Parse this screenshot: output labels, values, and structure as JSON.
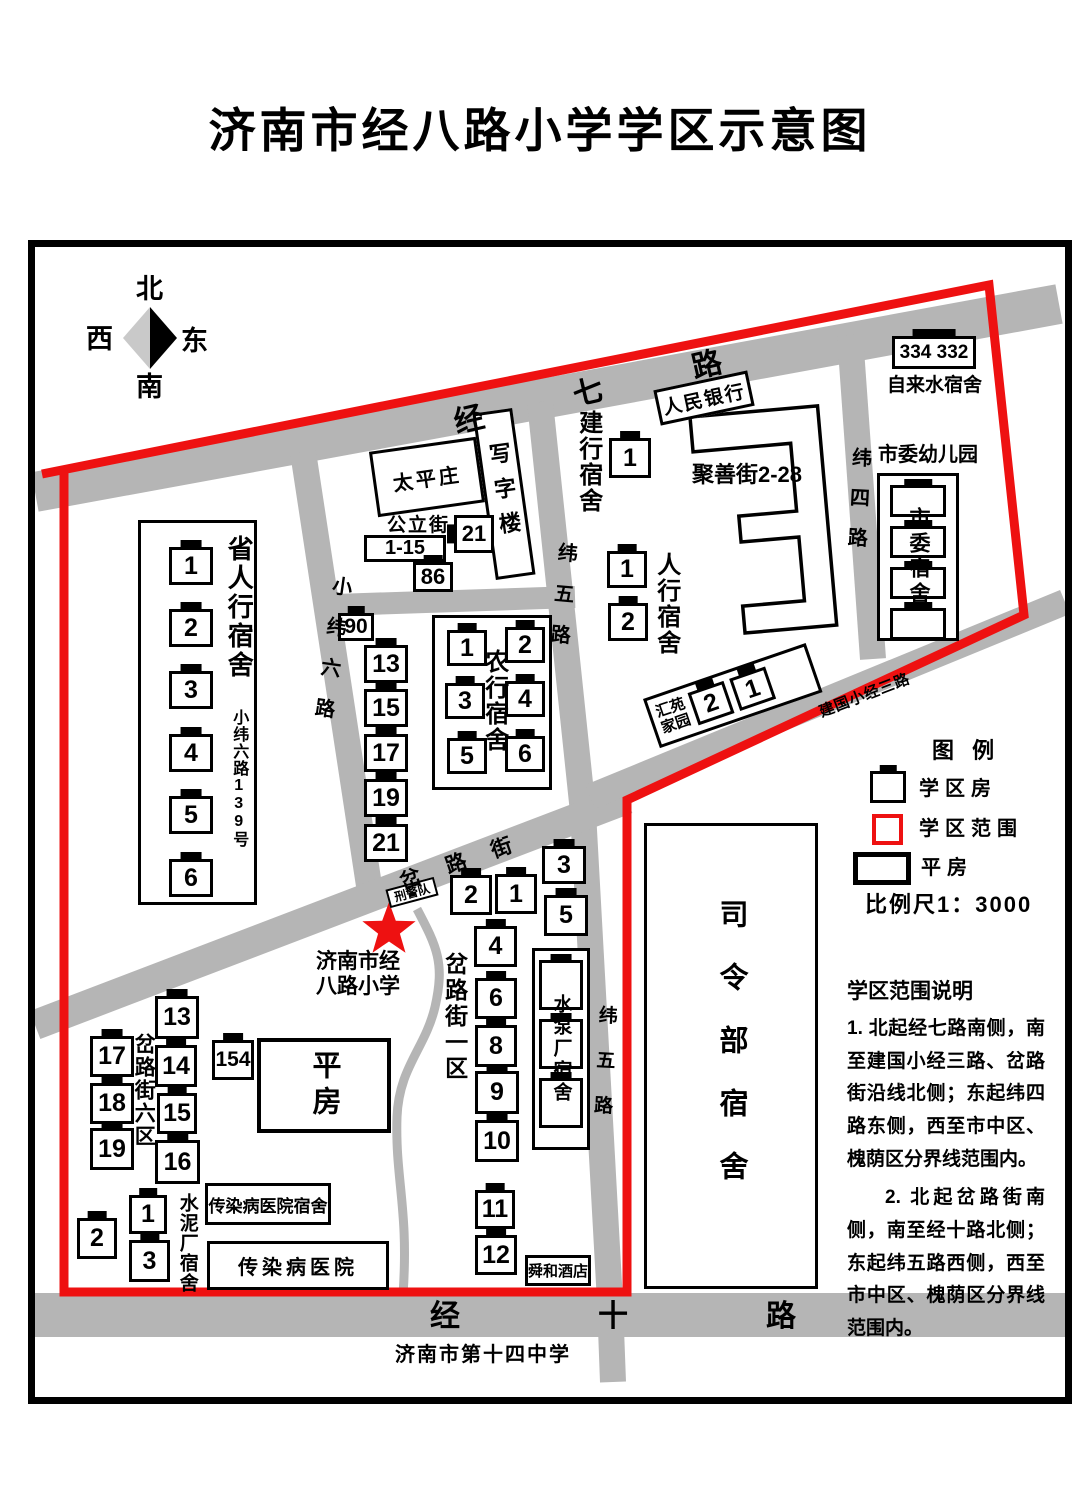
{
  "title": "济南市经八路小学学区示意图",
  "compass": {
    "north": "北",
    "west": "西",
    "east": "东",
    "south": "南"
  },
  "roads": {
    "jingqi": "经七路",
    "xiaoweiliu": "小纬六路",
    "weiwu": "纬五路",
    "weisi": "纬四路",
    "jianguo": "建国小经三路",
    "chalu": "岔路街",
    "jingshi": "经十路"
  },
  "areas": {
    "sheng": {
      "label": "省人行宿舍",
      "addr": "小纬六路139号",
      "units": [
        "1",
        "2",
        "3",
        "4",
        "5",
        "6"
      ]
    },
    "gongli": {
      "label": "公立街",
      "range": "1-15",
      "u21": "21",
      "u86": "86",
      "u90": "90"
    },
    "oddcol": {
      "units": [
        "13",
        "15",
        "17",
        "19",
        "21"
      ]
    },
    "taiping": {
      "label": "太平庄"
    },
    "xiezilou": {
      "label": "写字楼"
    },
    "nonghang": {
      "label": "农行宿舍",
      "units": [
        "1",
        "2",
        "3",
        "4",
        "5",
        "6"
      ]
    },
    "jianhang": {
      "label": "建行宿舍",
      "unit": "1"
    },
    "renminbank": {
      "label": "人民银行"
    },
    "renhang": {
      "label": "人行宿舍",
      "units": [
        "1",
        "2"
      ]
    },
    "jushan": {
      "label": "聚善街2-28"
    },
    "huiyuan": {
      "line1": "汇苑",
      "line2": "家园",
      "units": [
        "2",
        "1"
      ]
    },
    "zilaishui": {
      "number": "334 332",
      "label": "自来水宿舍"
    },
    "shiwei": {
      "kindergarten": "市委幼儿园",
      "dorm": "市委宿舍"
    },
    "siling": {
      "label": "司令部宿舍"
    },
    "xingjing": {
      "label": "刑警队"
    },
    "school": {
      "line1": "济南市经",
      "line2": "八路小学"
    },
    "yiqu": {
      "label": "岔路街一区",
      "units": [
        "2",
        "1",
        "3",
        "5",
        "4",
        "6",
        "8",
        "9",
        "10",
        "11",
        "12"
      ]
    },
    "shuibeng": {
      "label": "水泵厂宿舍"
    },
    "shunhe": {
      "label": "舜和酒店"
    },
    "liuqu": {
      "label": "岔路街六区",
      "units": [
        "13",
        "17",
        "14",
        "18",
        "15",
        "19",
        "16"
      ],
      "u154": "154"
    },
    "pingfang": {
      "label": "平房"
    },
    "shuini": {
      "label": "水泥厂宿舍",
      "units": [
        "1",
        "2",
        "3"
      ]
    },
    "chuanran_dorm": {
      "label": "传染病医院宿舍"
    },
    "chuanran_hosp": {
      "label": "传染病医院"
    },
    "no14": {
      "label": "济南市第十四中学"
    }
  },
  "legend": {
    "title": "图 例",
    "house": "学区房",
    "range": "学区范围",
    "pingfang": "平房",
    "scale": "比例尺1：3000"
  },
  "description": {
    "title": "学区范围说明",
    "p1": "1. 北起经七路南侧，南至建国小经三路、岔路街沿线北侧；东起纬四路东侧，西至市中区、槐荫区分界线范围内。",
    "p2": "2. 北起岔路街南侧，南至经十路北侧；东起纬五路西侧，西至市中区、槐荫区分界线范围内。"
  },
  "colors": {
    "boundary": "#ee1111",
    "road": "#b5b5b5"
  }
}
